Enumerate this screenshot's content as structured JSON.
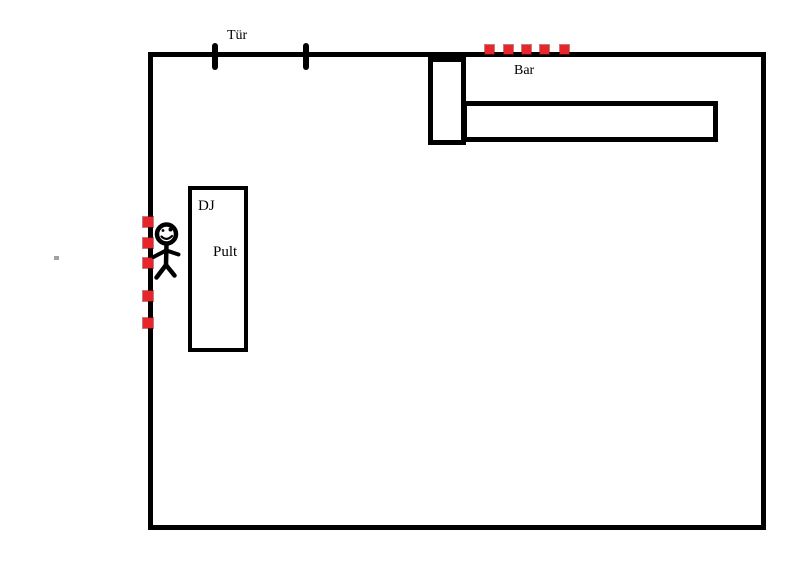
{
  "diagram": {
    "type": "room-floor-plan-sketch",
    "background_color": "#ffffff",
    "ink_color": "#000000",
    "accent_red": "#e8252b",
    "labels": {
      "door": "Tür",
      "bar": "Bar",
      "dj_line1": "DJ",
      "dj_line2": "Pult"
    },
    "markers": {
      "top_wall_dashes_x": [
        485,
        504,
        522,
        540,
        560
      ],
      "left_wall_dashes_y": [
        217,
        238,
        258,
        291,
        318
      ]
    },
    "shapes": {
      "room": "rectangle outline (main room)",
      "door_ticks": "two short vertical strokes on top wall marking door width",
      "bar_counter": "L-shaped counter of two rectangles in top-right corner",
      "dj_desk": "tall rectangle labeled DJ Pult",
      "person": "stick figure with smiley face standing left of DJ desk"
    }
  }
}
